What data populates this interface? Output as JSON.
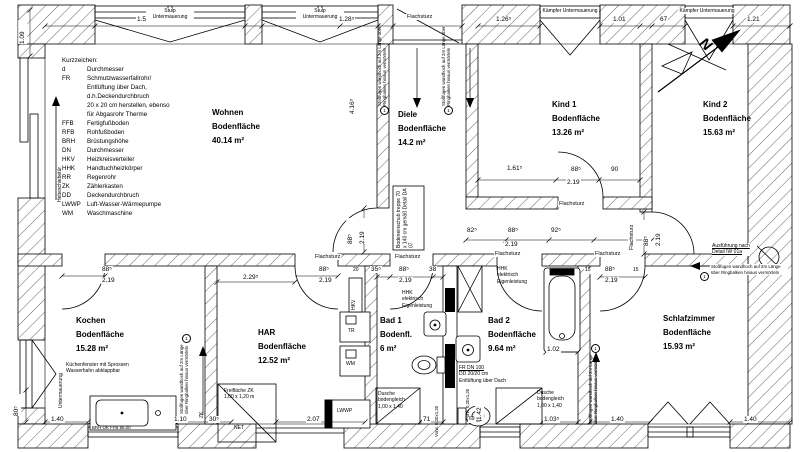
{
  "legend": {
    "title": "Kurzzeichen:",
    "entries": [
      {
        "a": "d",
        "d": "Durchmesser"
      },
      {
        "a": "FR",
        "d": "Schmutzwasserfallrohr/"
      },
      {
        "a": "",
        "d": "Entlüftung über Dach,"
      },
      {
        "a": "",
        "d": "d.h.Deckendurchbruch"
      },
      {
        "a": "",
        "d": "20 x 20 cm herstellen, ebenso"
      },
      {
        "a": "",
        "d": "für Abgasrohr Therme"
      },
      {
        "a": "FFB",
        "d": "Fertigfußboden"
      },
      {
        "a": "RFB",
        "d": "Rohfußboden"
      },
      {
        "a": "BRH",
        "d": "Brüstungshöhe"
      },
      {
        "a": "DN",
        "d": "Durchmesser"
      },
      {
        "a": "HKV",
        "d": "Heizkreisverteiler"
      },
      {
        "a": "HHK",
        "d": "Handtuchheizkörper"
      },
      {
        "a": "RR",
        "d": "Regenrohr"
      },
      {
        "a": "ZK",
        "d": "Zählerkasten"
      },
      {
        "a": "DD",
        "d": "Deckendurchbruch"
      },
      {
        "a": "LWWP",
        "d": "Luft-Wasser-Wärmepumpe"
      },
      {
        "a": "WM",
        "d": "Waschmaschine"
      }
    ]
  },
  "rooms": [
    {
      "name": "Wohnen",
      "sub": "Bodenfläche",
      "area": "40.14 m²"
    },
    {
      "name": "Diele",
      "sub": "Bodenfläche",
      "area": "14.2 m²"
    },
    {
      "name": "Kind 1",
      "sub": "Bodenfläche",
      "area": "13.26 m²"
    },
    {
      "name": "Kind 2",
      "sub": "Bodenfläche",
      "area": "15.63 m²"
    },
    {
      "name": "Kochen",
      "sub": "Bodenfläche",
      "area": "15.28 m²"
    },
    {
      "name": "HAR",
      "sub": "Bodenfläche",
      "area": "12.52 m²"
    },
    {
      "name": "Bad 1",
      "sub": "Bodenfl.",
      "area": "6 m²"
    },
    {
      "name": "Bad 2",
      "sub": "Bodenfläche",
      "area": "9.64 m²"
    },
    {
      "name": "Schlafzimmer",
      "sub": "Bodenfläche",
      "area": "15.93 m²"
    }
  ],
  "labels": {
    "stulp": "Stulp Untermauerung",
    "kaempfer": "Kämpfer Untermauerung",
    "flachsturz": "Flachsturz",
    "untermauerung": "Untermauerung",
    "hebeschiebetuer": "Hebeschiebetür",
    "stossfugen": "Stoßfugen wandhoch auf 2m Länge über Ringbalken hinaus vermörteln",
    "stossfugen_num": "1",
    "bodeneinschub_l1": "Bodeneinschub",
    "bodeneinschub_l2": "treppe 70 x 140 cm",
    "bodeneinschub_l3": "gemäß Detail DA 07",
    "ausfuehrung_l1": "Ausführung nach",
    "ausfuehrung_l2": "Detail IW 01a",
    "kuechenfenster_l1": "Küchenfenster mit Sprossen",
    "kuechenfenster_l2": "Wasserhahn abklappbar",
    "freiflaeche_l1": "Freifläche ZK",
    "freiflaeche_l2": "1,00 x 1,20 m",
    "net": "NET",
    "lwwp": "LWWP",
    "tr": "TR",
    "wm": "WM",
    "hkv": "HKV",
    "zk": "ZK",
    "hhk_l1": "HHK",
    "hhk_l2": "elektrisch",
    "hhk_l3": "Eigenleistung",
    "fr_l1": "FR DN 100",
    "fr_l2": "DD 20/20 cm",
    "fr_l3": "Entlüftung über Dach",
    "dusche_l1": "Dusche",
    "dusche_l2": "bodengleich",
    "dusche_l3": "1,00 x 1,40",
    "brh": "BRH OK FFB 86.00",
    "vorwand": "Vorw. 0,20x1,20",
    "north": "N"
  },
  "dims": {
    "v109": "1.09",
    "t153": "1.53⁵",
    "t128": "1.28⁵",
    "t126": "1.26⁵",
    "t101": "1.01",
    "t67": "67",
    "t121": "1.21",
    "w416": "4.16⁵",
    "d88": "88⁵",
    "d219": "2.19",
    "d90": "90",
    "d161": "1.61⁵",
    "d82": "82⁵",
    "d92": "92⁵",
    "d229": "2.29⁵",
    "d20": "20",
    "d35": "35⁵",
    "d38": "38",
    "d15": "15",
    "tub102": "1.02",
    "v142": "1.42",
    "b140": "1.40",
    "b110": "1.10",
    "b30": "30⁵",
    "b207": "2.07",
    "b71": "71",
    "b69": "69",
    "b103": "1.03⁵",
    "b80": "80⁵"
  }
}
